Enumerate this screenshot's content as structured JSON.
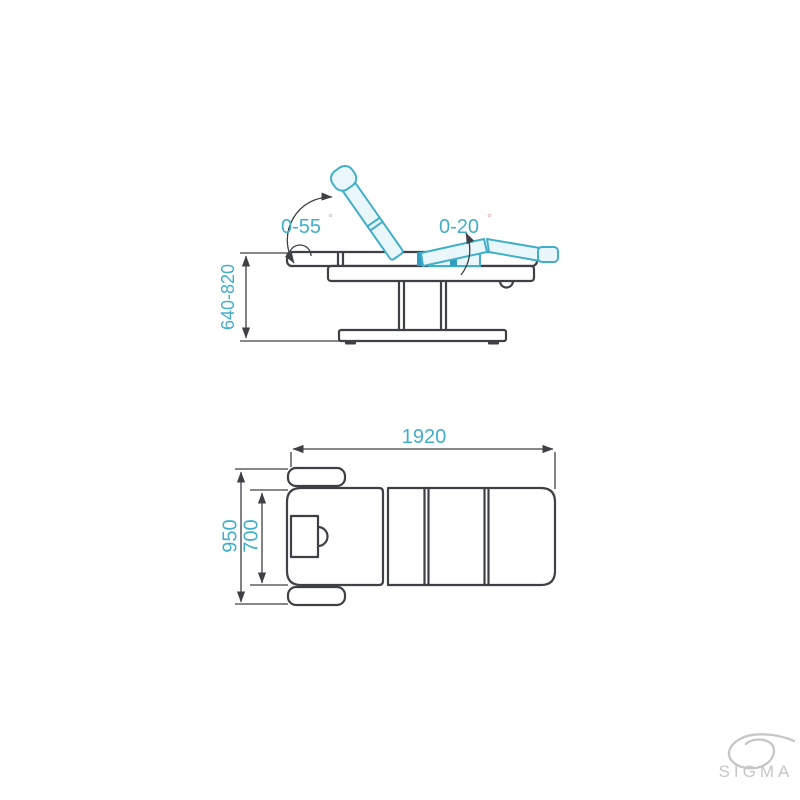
{
  "colors": {
    "background": "#ffffff",
    "line": "#3e4045",
    "accent": "#42afc9",
    "accent_fill": "#e9f6fa",
    "accent_solid": "#2f9cc0",
    "degree": "#d9a39e",
    "logo": "#c6c6c6"
  },
  "side_view": {
    "backrest_angle": "0-55",
    "legrest_angle": "0-20",
    "degree": "°",
    "height_range": "640-820"
  },
  "top_view": {
    "length": "1920",
    "width_overall": "950",
    "width_bed": "700"
  },
  "logo": {
    "name": "SIGMA"
  }
}
